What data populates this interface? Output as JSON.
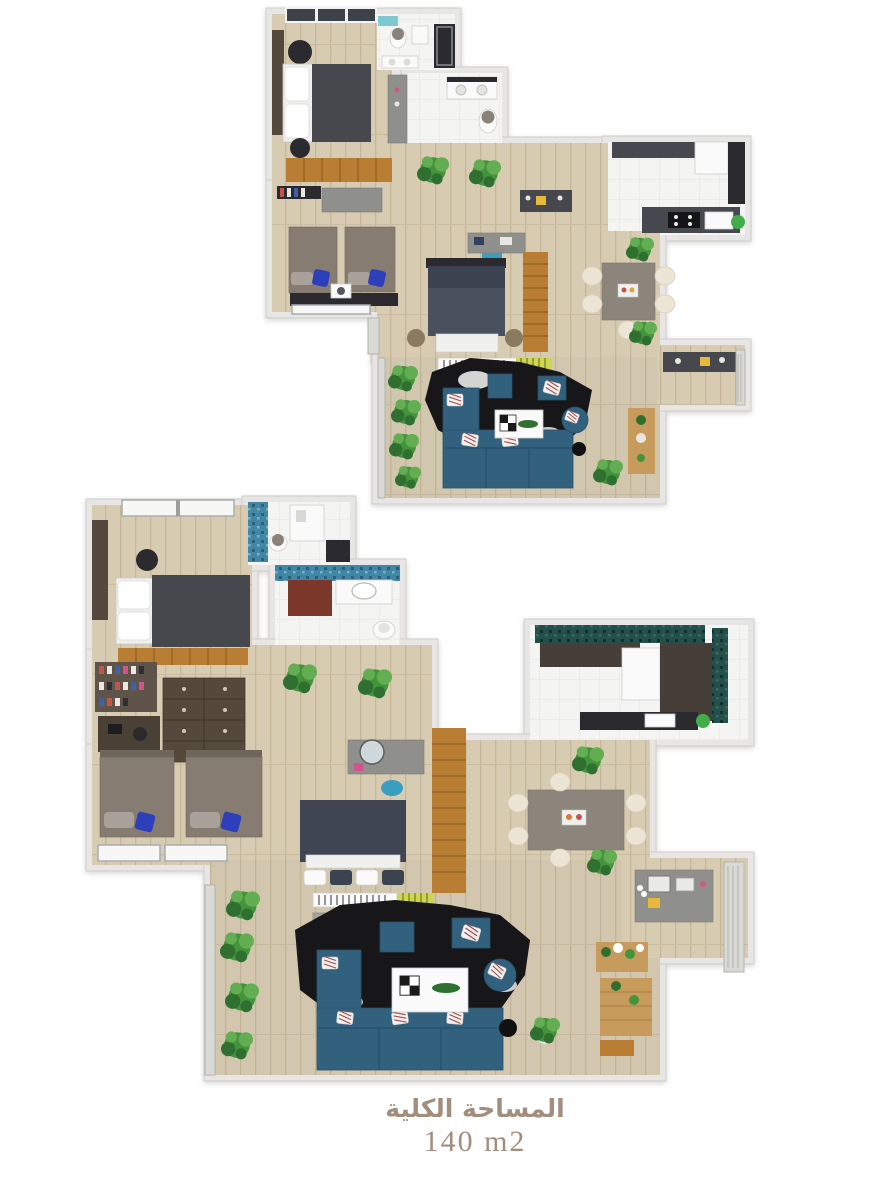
{
  "caption": {
    "title_ar": "المساحة الكلية",
    "area_value": "140 m2"
  },
  "palette": {
    "wall": "#e7e6e4",
    "wall_stroke": "#cfcec9",
    "floor_wood": "#d7cbb1",
    "floor_plank_line": "#c5b797",
    "floor_tile": "#f4f4f3",
    "dark_furniture": "#47474e",
    "dark_deep": "#2b2b2f",
    "bed_taupe": "#867c72",
    "pillow_gray": "#aaa29a",
    "pillow_blue": "#2e3fbb",
    "bedding_white": "#f4f4f4",
    "wood_accent": "#b97e33",
    "wood_accent_dark": "#8f5f20",
    "wood_light": "#c79b5c",
    "sofa_blue": "#32617e",
    "rug_black": "#17171a",
    "plant_green": "#44943c",
    "plant_dark": "#2f7030",
    "plant_light": "#63ad52",
    "cream_chair": "#ece4d4",
    "table_gray": "#8c857b",
    "gray_furniture": "#8f8f8c",
    "mosaic_blue": "#4286a5",
    "mosaic_teal": "#24504c",
    "maroon_cabinet": "#7c382b",
    "red_accent": "#a8292a",
    "tv_orange": "#d97a26",
    "counter_brown": "#453f38",
    "green_dot": "#3fae4a",
    "chair_blue": "#3a9ec0",
    "yellow_note": "#e6b83c",
    "caption_text": "#a28e7d"
  }
}
